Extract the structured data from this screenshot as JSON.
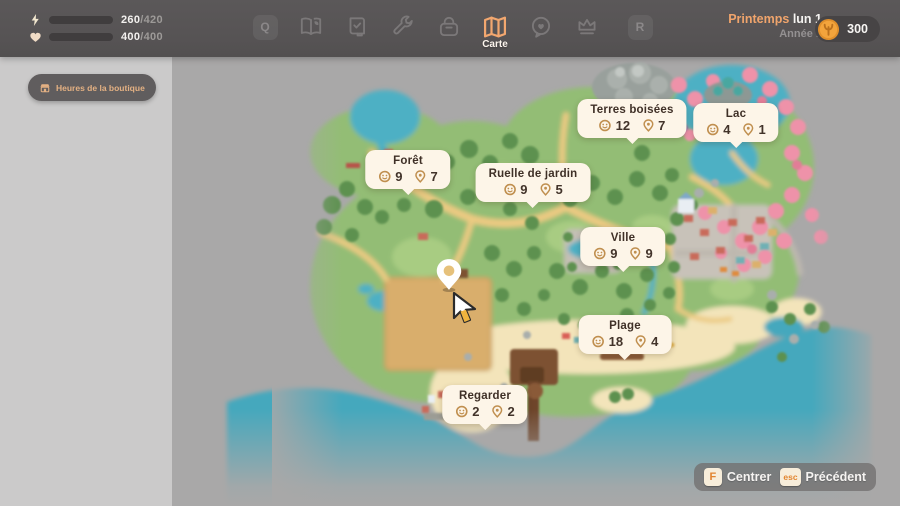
{
  "topbar": {
    "energy": {
      "value": "260",
      "max": "/420",
      "percent": 62
    },
    "health": {
      "value": "400",
      "max": "/400",
      "percent": 100
    },
    "left_key_hint": "Q",
    "right_key_hint": "R",
    "active_tab_label": "Carte",
    "date": {
      "season": "Printemps",
      "day": "lun 1",
      "year": "Année 1"
    },
    "currency": {
      "amount": "300"
    }
  },
  "sidebar": {
    "shop_hours_button": "Heures de la boutique"
  },
  "map": {
    "regions": [
      {
        "name": "Terres boisées",
        "npc_count": "12",
        "location_count": "7"
      },
      {
        "name": "Lac",
        "npc_count": "4",
        "location_count": "1"
      },
      {
        "name": "Forêt",
        "npc_count": "9",
        "location_count": "7"
      },
      {
        "name": "Ruelle de jardin",
        "npc_count": "9",
        "location_count": "5"
      },
      {
        "name": "Ville",
        "npc_count": "9",
        "location_count": "9"
      },
      {
        "name": "Plage",
        "npc_count": "18",
        "location_count": "4"
      },
      {
        "name": "Regarder",
        "npc_count": "2",
        "location_count": "2"
      }
    ],
    "help_buttons": [
      {
        "key": "F",
        "label": "Centrer"
      },
      {
        "key": "esc",
        "label": "Précédent"
      }
    ]
  }
}
